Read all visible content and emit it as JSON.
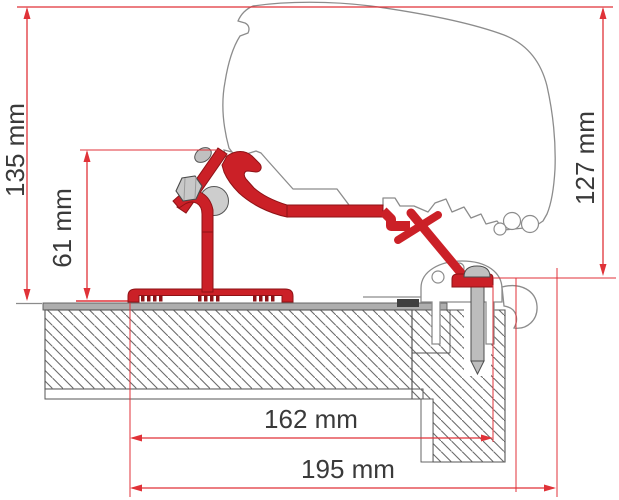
{
  "diagram": {
    "type": "technical-drawing",
    "subject": "Awning roof adapter bracket installation cross-section",
    "unit": "mm",
    "labels": {
      "height_overall": "135 mm",
      "height_bracket": "61 mm",
      "height_rear": "127 mm",
      "width_inner": "162 mm",
      "width_outer": "195 mm"
    },
    "measurements": {
      "height_overall_mm": 135,
      "height_bracket_mm": 61,
      "height_rear_mm": 127,
      "width_inner_mm": 162,
      "width_outer_mm": 195
    },
    "colors": {
      "dimension_line": "#e03238",
      "bracket_fill": "#cb2027",
      "bracket_outline": "#8e1216",
      "profile_outline": "#8c8c8c",
      "hatch_line": "#6b6b6b",
      "metal_fill": "#c6c6c6",
      "label_text": "#3a3a3a"
    }
  }
}
